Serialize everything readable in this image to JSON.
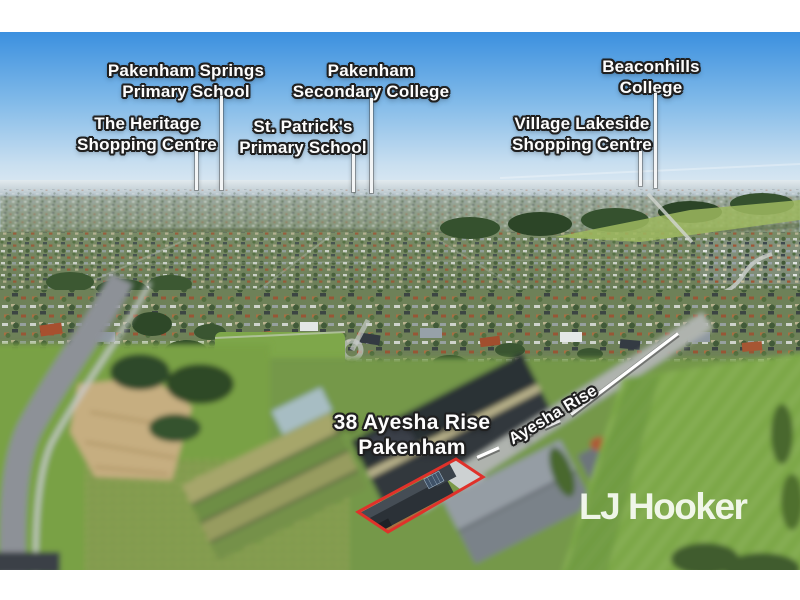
{
  "landmarks": [
    {
      "name": "Pakenham Springs Primary School",
      "line1": "Pakenham Springs",
      "line2": "Primary School"
    },
    {
      "name": "The Heritage Shopping Centre",
      "line1": "The Heritage",
      "line2": "Shopping Centre"
    },
    {
      "name": "St. Patrick's Primary School",
      "line1": "St. Patrick's",
      "line2": "Primary School"
    },
    {
      "name": "Pakenham Secondary College",
      "line1": "Pakenham",
      "line2": "Secondary College"
    },
    {
      "name": "Village Lakeside Shopping Centre",
      "line1": "Village Lakeside",
      "line2": "Shopping Centre"
    },
    {
      "name": "Beaconhills College",
      "line1": "Beaconhills",
      "line2": "College"
    }
  ],
  "property": {
    "address_line1": "38 Ayesha Rise",
    "address_line2": "Pakenham",
    "street_name": "Ayesha Rise",
    "boundary_color": "#e0312a",
    "annotation_line_color": "#ffffff"
  },
  "branding": {
    "agency_logo_text": "LJ Hooker",
    "logo_color": "#f3f6ee"
  }
}
